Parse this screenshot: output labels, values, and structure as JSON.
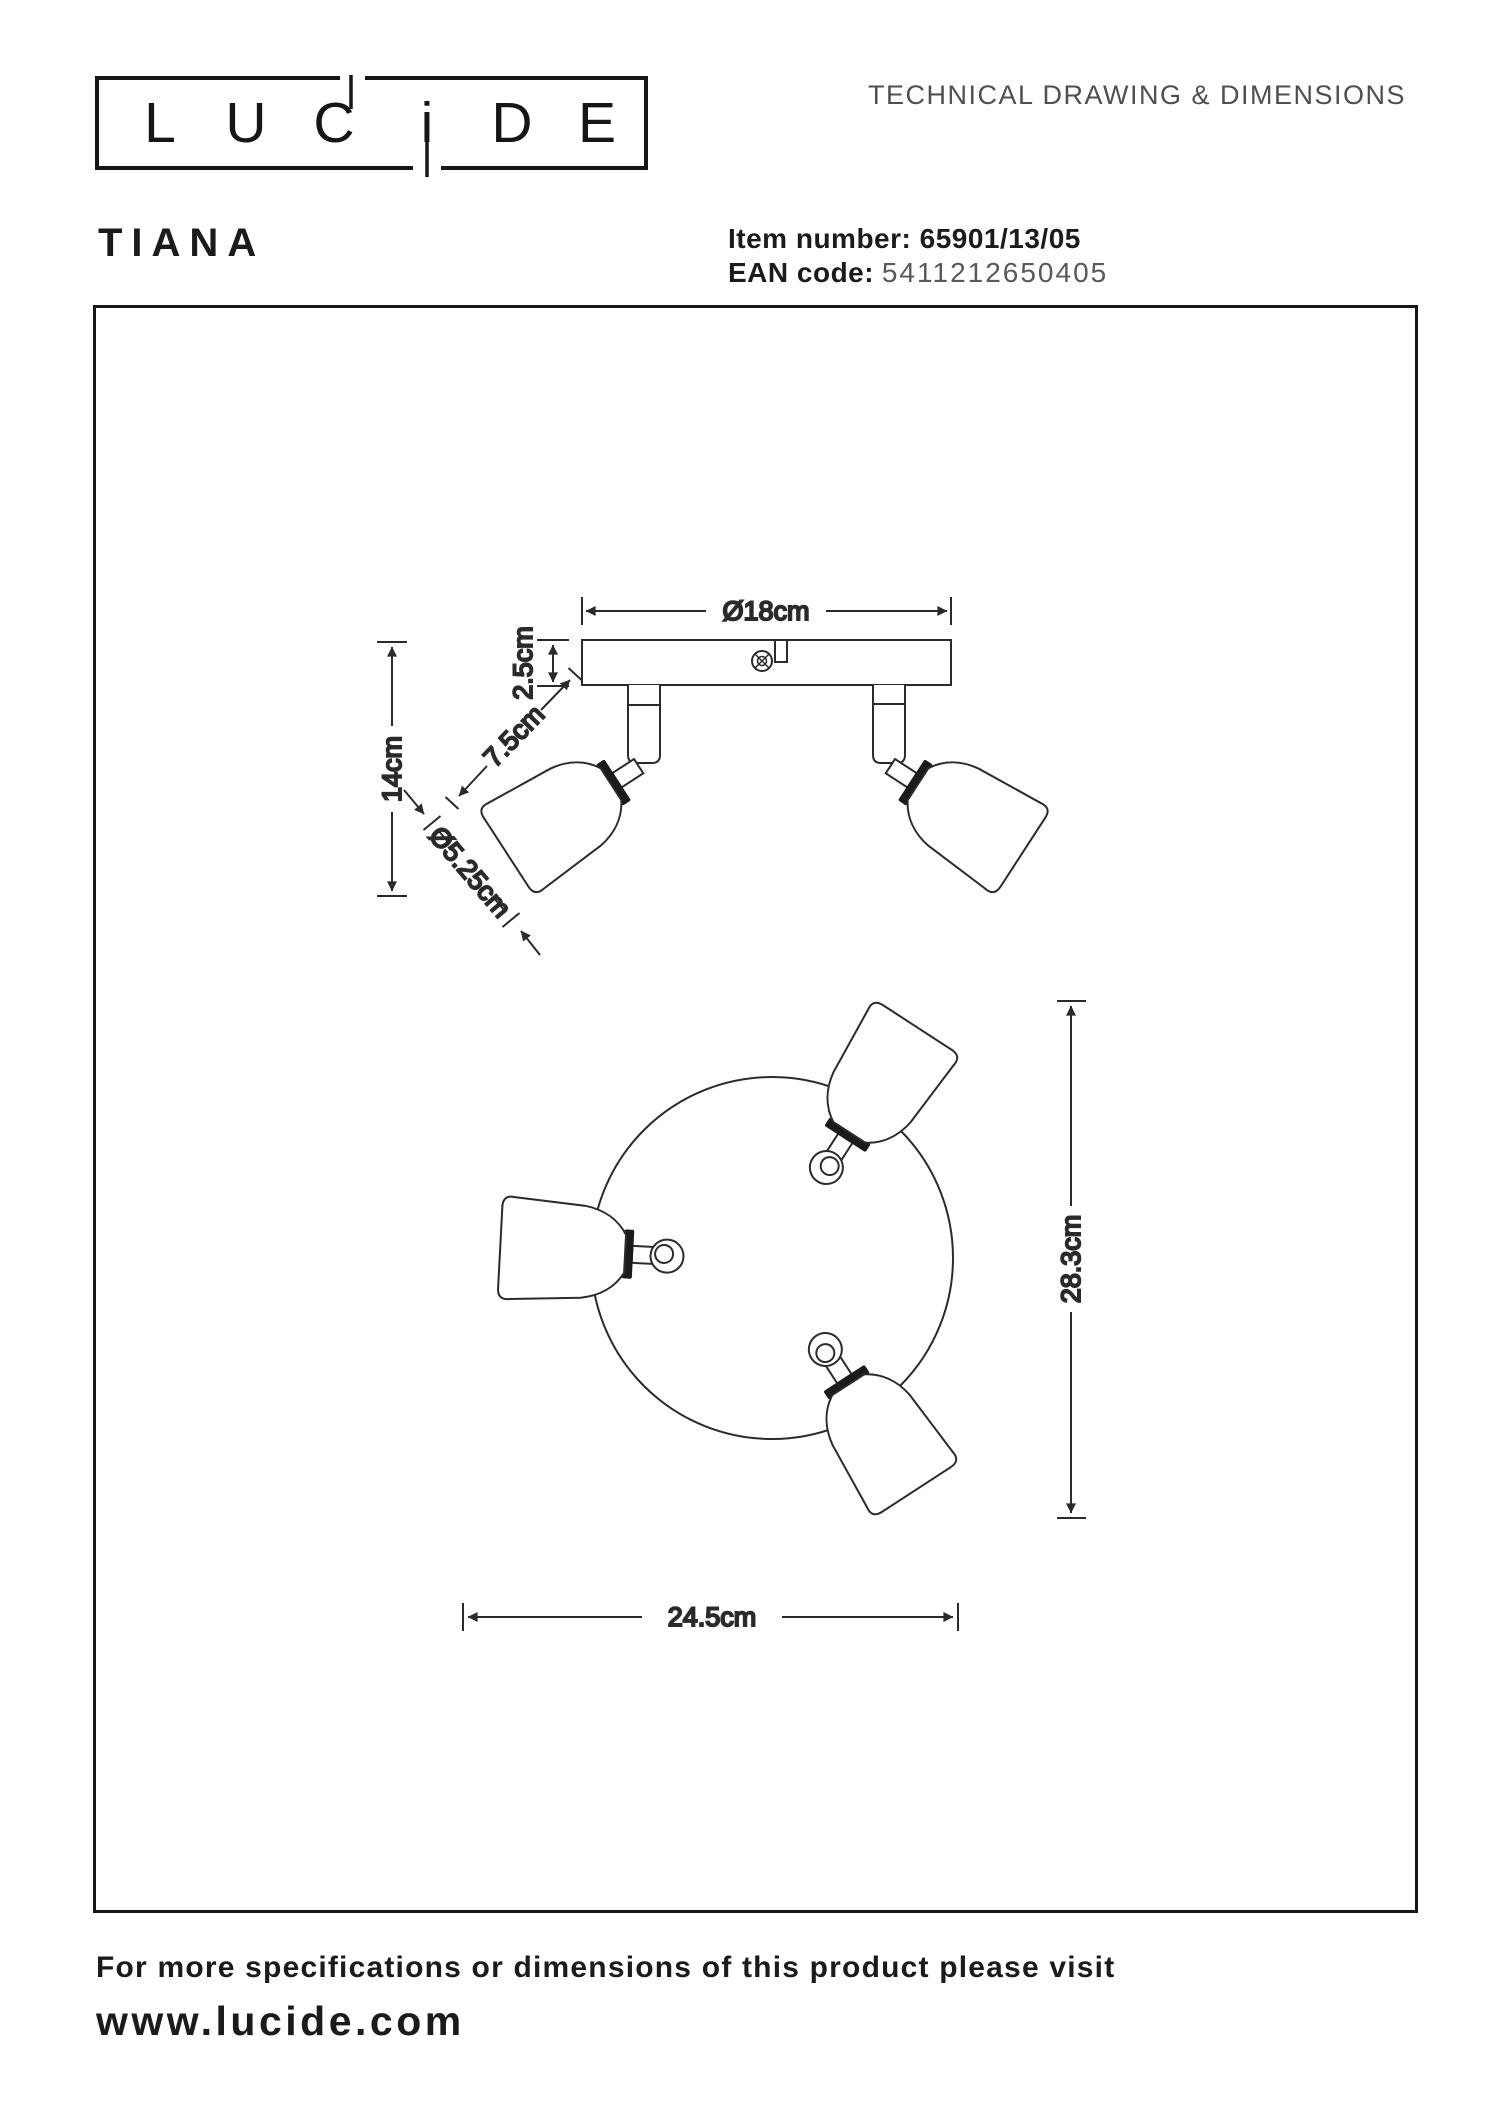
{
  "header": {
    "doc_title": "TECHNICAL DRAWING & DIMENSIONS"
  },
  "logo": {
    "letters": [
      "L",
      "U",
      "C",
      "i",
      "D",
      "E"
    ]
  },
  "product": {
    "name": "TIANA",
    "item_label": "Item number:",
    "item_value": "65901/13/05",
    "ean_label": "EAN code:",
    "ean_value": "5411212650405"
  },
  "dimensions": {
    "base_diameter": "Ø18cm",
    "base_height": "2.5cm",
    "total_height": "14cm",
    "shade_length": "7.5cm",
    "shade_diameter": "Ø5.25cm",
    "layout_height": "28.3cm",
    "layout_width": "24.5cm"
  },
  "footer": {
    "line1": "For more specifications or dimensions of this product please visit",
    "line2": "www.lucide.com"
  },
  "colors": {
    "ink": "#1b1b1b",
    "muted": "#4f4f4f",
    "line": "#2b2b2b"
  }
}
